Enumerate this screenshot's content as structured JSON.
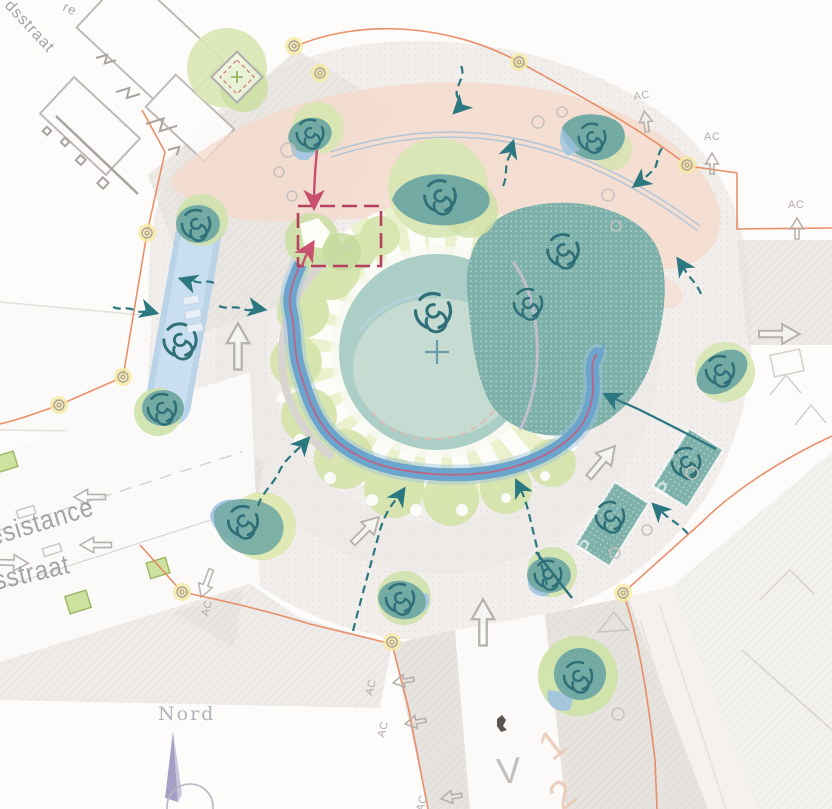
{
  "map": {
    "type": "landscape-site-plan-roundabout",
    "compass": {
      "label": "Nord"
    },
    "street_labels": [
      {
        "id": "top-left-fragment",
        "text": "re"
      },
      {
        "id": "dsstraat",
        "text": "dsstraat"
      },
      {
        "id": "esistance",
        "text": "esistance"
      },
      {
        "id": "sstraat",
        "text": "sstraat"
      }
    ],
    "ac_markers": [
      {
        "text": "AC"
      },
      {
        "text": "AC"
      },
      {
        "text": "AC"
      },
      {
        "text": "AC"
      },
      {
        "text": "AC"
      },
      {
        "text": "AC"
      },
      {
        "text": "AC"
      }
    ],
    "road_markings": [
      {
        "text": "V"
      },
      {
        "text": "1"
      },
      {
        "text": "2"
      },
      {
        "text": "P"
      },
      {
        "text": "P"
      }
    ],
    "colors": {
      "background": "#fdfcfb",
      "plaza": "#f1eeec",
      "sidewalk_hatch": "#e7e3df",
      "pink_zone": "#f6d9cb",
      "teal_bed": "#7eb1aa",
      "central_pond": "#abcfc6",
      "canopy_green": "#d7e6b0",
      "stream_blue": "#6ba4cd",
      "canal_blue": "#b9d3e9",
      "accent_red": "#c9506e",
      "flow_arrow_teal": "#2c7880",
      "perimeter_orange": "#e8845a",
      "node_yellow": "#f7ea9e",
      "gray_line": "#b5b1ad"
    }
  }
}
